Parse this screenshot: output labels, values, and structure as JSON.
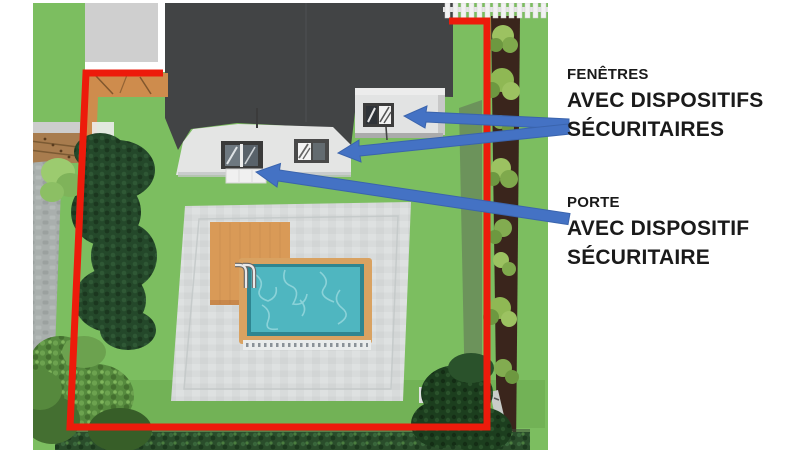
{
  "slide": {
    "background": "#FFFFFF"
  },
  "labels": {
    "windows": {
      "line1": "FENÊTRES",
      "line2": "AVEC DISPOSITIFS",
      "line3": "SÉCURITAIRES"
    },
    "door": {
      "line1": "PORTE",
      "line2": "AVEC DISPOSITIF",
      "line3": "SÉCURITAIRE"
    }
  },
  "colors": {
    "perimeter_red": "#ED1B0B",
    "arrow_blue": "#4472C4",
    "arrow_blue_edge": "#3A64AD",
    "grass_green": "#7CBE60",
    "roof_gray": "#424445",
    "house_wall_gray": "#E4E5E4",
    "pool_water_teal": "#4FB6C0",
    "pool_coping_tan": "#D9A261",
    "patio_gray": "#D8DBDB",
    "deck_orange": "#D99A57",
    "text_black": "#1A1A1A"
  }
}
